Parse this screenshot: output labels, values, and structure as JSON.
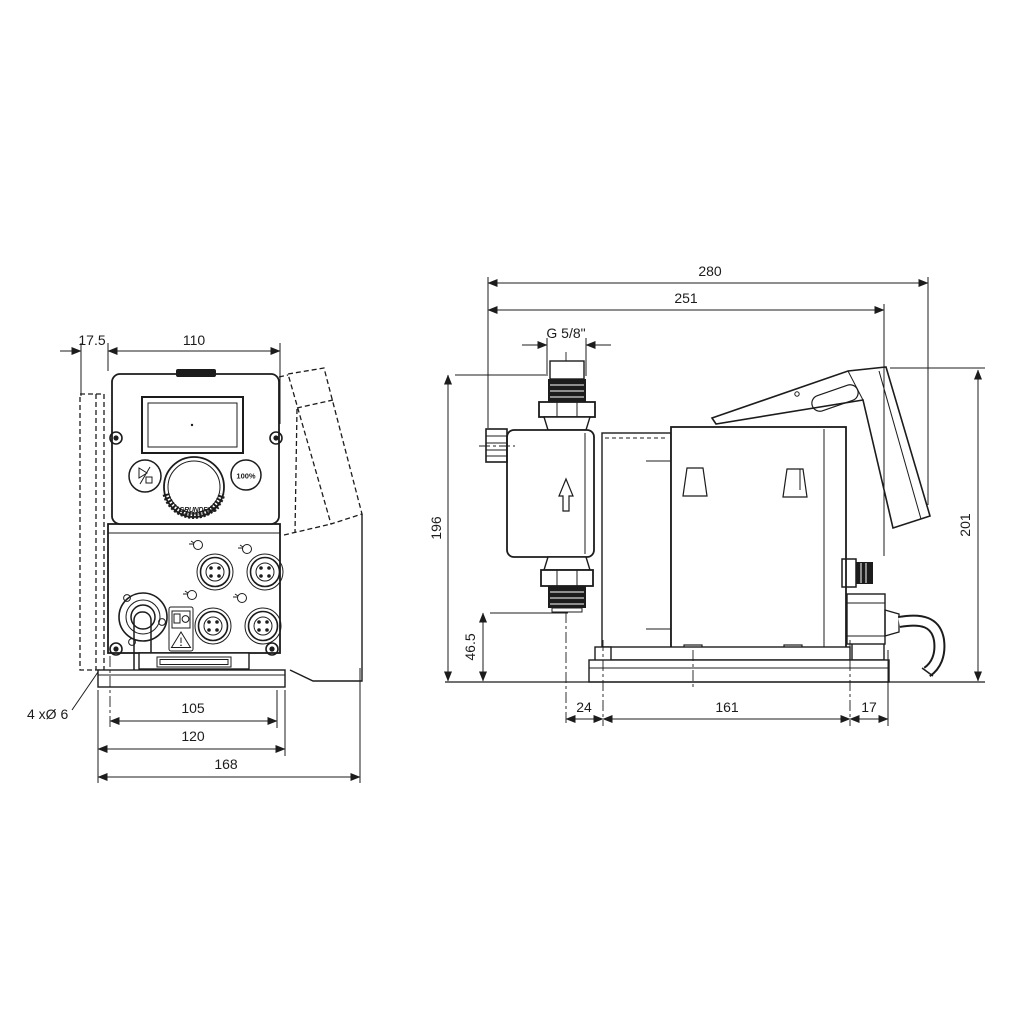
{
  "view_front": {
    "dim_offset": "17.5",
    "dim_top_width": "110",
    "dim_hole_span": "105",
    "dim_plate_width": "120",
    "dim_total_width": "168",
    "holes_note": "4 xØ 6",
    "btn_100": "100%",
    "logo": "GRUNDFOS"
  },
  "view_side": {
    "dim_total_depth": "280",
    "dim_body_depth": "251",
    "thread": "G 5/8\"",
    "dim_height_port": "196",
    "dim_height_valve": "46.5",
    "dim_height_total": "201",
    "dim_front_overhang": "24",
    "dim_base_length": "161",
    "dim_rear_overhang": "17"
  },
  "colors": {
    "background": "#ffffff",
    "line": "#1c1c1c"
  }
}
